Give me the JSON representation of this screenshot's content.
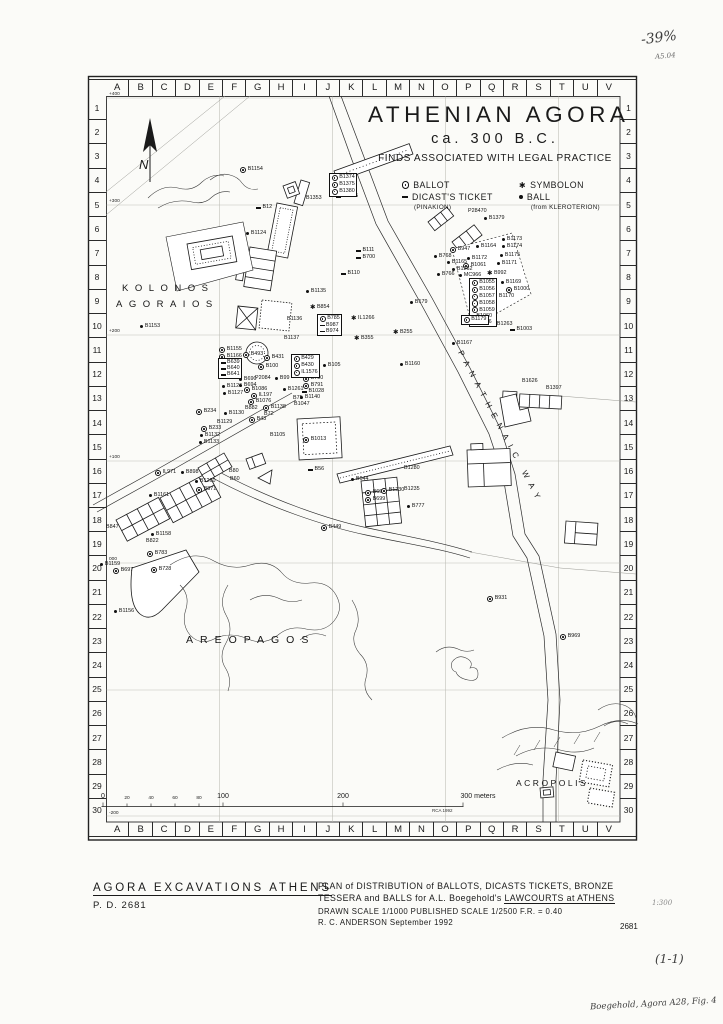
{
  "title": {
    "main": "ATHENIAN AGORA",
    "date": "ca. 300 B.C.",
    "subtitle": "FINDS ASSOCIATED WITH LEGAL PRACTICE"
  },
  "legend": {
    "columns": [
      [
        {
          "sym": "ballot",
          "label": "BALLOT"
        },
        {
          "sym": "ticket",
          "label": "DICAST'S TICKET",
          "sub": "(PINAKION)"
        }
      ],
      [
        {
          "sym": "symbolon",
          "label": "SYMBOLON"
        },
        {
          "sym": "ball",
          "label": "BALL",
          "sub": "(from KLEROTERION)"
        }
      ]
    ]
  },
  "compass": {
    "north": "N"
  },
  "grid": {
    "columns": [
      "A",
      "B",
      "C",
      "D",
      "E",
      "F",
      "G",
      "H",
      "I",
      "J",
      "K",
      "L",
      "M",
      "N",
      "O",
      "P",
      "Q",
      "R",
      "S",
      "T",
      "U",
      "V"
    ],
    "rows": [
      "1",
      "2",
      "3",
      "4",
      "5",
      "6",
      "7",
      "8",
      "9",
      "10",
      "11",
      "12",
      "13",
      "14",
      "15",
      "16",
      "17",
      "18",
      "19",
      "20",
      "21",
      "22",
      "23",
      "24",
      "25",
      "26",
      "27",
      "28",
      "29",
      "30"
    ],
    "elevations": [
      {
        "t": "+400",
        "y": 97
      },
      {
        "t": "+300",
        "y": 204
      },
      {
        "t": "+200",
        "y": 334
      },
      {
        "t": "+100",
        "y": 460
      },
      {
        "t": "000",
        "y": 562
      },
      {
        "t": "-200",
        "y": 816
      }
    ]
  },
  "region_labels": [
    {
      "text": "KOLONOS",
      "x": 122,
      "y": 283,
      "cls": "kolonos"
    },
    {
      "text": "AGORAIOS",
      "x": 116,
      "y": 299,
      "cls": "kolonos"
    },
    {
      "text": "AREOPAGOS",
      "x": 186,
      "y": 634,
      "cls": "areopagos"
    },
    {
      "text": "ACROPOLIS",
      "x": 516,
      "y": 778,
      "cls": "acropolis"
    },
    {
      "text": "PANATHENAIC WAY",
      "x": 464,
      "y": 349,
      "cls": "panathenaic"
    }
  ],
  "markers": [
    {
      "s": "ballot",
      "l": "B1154",
      "x": 240,
      "y": 170
    },
    {
      "s": "ticket",
      "l": "B1465",
      "x": 336,
      "y": 197
    },
    {
      "s": "none",
      "l": "B1353",
      "x": 306,
      "y": 199
    },
    {
      "s": "ticket",
      "l": "B12",
      "x": 256,
      "y": 208
    },
    {
      "s": "ball",
      "l": "B1124",
      "x": 246,
      "y": 234
    },
    {
      "s": "none",
      "l": "P28470",
      "x": 468,
      "y": 212
    },
    {
      "s": "ball",
      "l": "B1379",
      "x": 484,
      "y": 219
    },
    {
      "s": "ticket",
      "l": "B111",
      "x": 356,
      "y": 251
    },
    {
      "s": "ticket",
      "l": "B700",
      "x": 356,
      "y": 258
    },
    {
      "s": "ticket",
      "l": "B110",
      "x": 341,
      "y": 274
    },
    {
      "s": "ball",
      "l": "B1173",
      "x": 502,
      "y": 240
    },
    {
      "s": "ball",
      "l": "B1174",
      "x": 502,
      "y": 247
    },
    {
      "s": "ballot",
      "l": "B947",
      "x": 450,
      "y": 250
    },
    {
      "s": "ball",
      "l": "B1164",
      "x": 476,
      "y": 247
    },
    {
      "s": "ball",
      "l": "B768",
      "x": 434,
      "y": 257
    },
    {
      "s": "ball",
      "l": "B1165",
      "x": 447,
      "y": 263
    },
    {
      "s": "ball",
      "l": "B1172",
      "x": 467,
      "y": 259
    },
    {
      "s": "ballot",
      "l": "B1061",
      "x": 463,
      "y": 266
    },
    {
      "s": "ball",
      "l": "B1175",
      "x": 500,
      "y": 256
    },
    {
      "s": "ball",
      "l": "B1171",
      "x": 497,
      "y": 264
    },
    {
      "s": "ball",
      "l": "B1262",
      "x": 452,
      "y": 270
    },
    {
      "s": "ball",
      "l": "B766",
      "x": 437,
      "y": 275
    },
    {
      "s": "ball",
      "l": "MC966",
      "x": 459,
      "y": 276
    },
    {
      "s": "symbolon",
      "l": "B992",
      "x": 487,
      "y": 274
    },
    {
      "s": "ball",
      "l": "B1169",
      "x": 501,
      "y": 283
    },
    {
      "s": "ballot",
      "l": "B1000",
      "x": 506,
      "y": 290
    },
    {
      "s": "ball",
      "l": "B1170",
      "x": 494,
      "y": 297
    },
    {
      "s": "ball",
      "l": "B1263",
      "x": 492,
      "y": 325
    },
    {
      "s": "ticket",
      "l": "B1003",
      "x": 510,
      "y": 330
    },
    {
      "s": "ball",
      "l": "B179",
      "x": 410,
      "y": 303
    },
    {
      "s": "ball",
      "l": "B1167",
      "x": 452,
      "y": 344
    },
    {
      "s": "ball",
      "l": "B1160",
      "x": 400,
      "y": 365
    },
    {
      "s": "none",
      "l": "B1626",
      "x": 522,
      "y": 382
    },
    {
      "s": "none",
      "l": "B1397",
      "x": 546,
      "y": 389
    },
    {
      "s": "ball",
      "l": "B1135",
      "x": 306,
      "y": 292
    },
    {
      "s": "symbolon",
      "l": "B854",
      "x": 310,
      "y": 308
    },
    {
      "s": "none",
      "l": "B1136",
      "x": 287,
      "y": 320
    },
    {
      "s": "symbolon",
      "l": "IL1266",
      "x": 351,
      "y": 319
    },
    {
      "s": "symbolon",
      "l": "B355",
      "x": 354,
      "y": 339
    },
    {
      "s": "symbolon",
      "l": "B255",
      "x": 393,
      "y": 333
    },
    {
      "s": "none",
      "l": "B1137",
      "x": 284,
      "y": 339
    },
    {
      "s": "ball",
      "l": "B1153",
      "x": 140,
      "y": 327
    },
    {
      "s": "ballot",
      "l": "B1155",
      "x": 219,
      "y": 350
    },
    {
      "s": "ballot",
      "l": "B1166",
      "x": 219,
      "y": 357
    },
    {
      "s": "ball",
      "l": "B1126",
      "x": 222,
      "y": 387
    },
    {
      "s": "ball",
      "l": "B1127",
      "x": 223,
      "y": 394
    },
    {
      "s": "ballot",
      "l": "B234",
      "x": 196,
      "y": 412
    },
    {
      "s": "ball",
      "l": "B1130",
      "x": 224,
      "y": 414
    },
    {
      "s": "none",
      "l": "B1129",
      "x": 217,
      "y": 423
    },
    {
      "s": "ballot",
      "l": "B233",
      "x": 201,
      "y": 429
    },
    {
      "s": "ball",
      "l": "B1132",
      "x": 200,
      "y": 436
    },
    {
      "s": "ball",
      "l": "B1133",
      "x": 199,
      "y": 443
    },
    {
      "s": "ballot",
      "l": "B493",
      "x": 243,
      "y": 355
    },
    {
      "s": "ballot",
      "l": "B431",
      "x": 264,
      "y": 358
    },
    {
      "s": "ballot",
      "l": "B100",
      "x": 258,
      "y": 367
    },
    {
      "s": "ball",
      "l": "B105",
      "x": 323,
      "y": 366
    },
    {
      "s": "ballot",
      "l": "B790",
      "x": 303,
      "y": 379
    },
    {
      "s": "ballot",
      "l": "B791",
      "x": 303,
      "y": 386
    },
    {
      "s": "ticket",
      "l": "B1028",
      "x": 302,
      "y": 392
    },
    {
      "s": "ball",
      "l": "B1140",
      "x": 300,
      "y": 398
    },
    {
      "s": "ball",
      "l": "B690",
      "x": 239,
      "y": 380
    },
    {
      "s": "ball",
      "l": "B694",
      "x": 239,
      "y": 386
    },
    {
      "s": "none",
      "l": "P2084",
      "x": 255,
      "y": 379
    },
    {
      "s": "ball",
      "l": "B99",
      "x": 275,
      "y": 379
    },
    {
      "s": "ballot",
      "l": "B1086",
      "x": 244,
      "y": 390
    },
    {
      "s": "ballot",
      "l": "IL197",
      "x": 251,
      "y": 396
    },
    {
      "s": "ballot",
      "l": "B1076",
      "x": 248,
      "y": 402
    },
    {
      "s": "ball",
      "l": "B1261",
      "x": 283,
      "y": 390
    },
    {
      "s": "none",
      "l": "B75",
      "x": 293,
      "y": 399
    },
    {
      "s": "none",
      "l": "B1047",
      "x": 294,
      "y": 405
    },
    {
      "s": "ballot",
      "l": "B1138",
      "x": 263,
      "y": 408
    },
    {
      "s": "none",
      "l": "B72",
      "x": 264,
      "y": 415
    },
    {
      "s": "none",
      "l": "B882",
      "x": 245,
      "y": 409
    },
    {
      "s": "ballot",
      "l": "B43",
      "x": 249,
      "y": 420
    },
    {
      "s": "none",
      "l": "B1105",
      "x": 270,
      "y": 436
    },
    {
      "s": "ballot",
      "l": "B1013",
      "x": 303,
      "y": 440
    },
    {
      "s": "ticket",
      "l": "B56",
      "x": 308,
      "y": 470
    },
    {
      "s": "none",
      "l": "B80",
      "x": 229,
      "y": 472
    },
    {
      "s": "none",
      "l": "B60",
      "x": 230,
      "y": 480
    },
    {
      "s": "ballot",
      "l": "IL971",
      "x": 155,
      "y": 473
    },
    {
      "s": "ball",
      "l": "B898",
      "x": 181,
      "y": 473
    },
    {
      "s": "ball",
      "l": "B1260",
      "x": 195,
      "y": 482
    },
    {
      "s": "ballot",
      "l": "B871",
      "x": 196,
      "y": 490
    },
    {
      "s": "ball",
      "l": "B1161",
      "x": 149,
      "y": 496
    },
    {
      "s": "none",
      "l": "B847",
      "x": 106,
      "y": 528
    },
    {
      "s": "ball",
      "l": "B1158",
      "x": 151,
      "y": 535
    },
    {
      "s": "none",
      "l": "B822",
      "x": 146,
      "y": 542
    },
    {
      "s": "ballot",
      "l": "B783",
      "x": 147,
      "y": 554
    },
    {
      "s": "ball",
      "l": "B1159",
      "x": 100,
      "y": 565
    },
    {
      "s": "ballot",
      "l": "B697",
      "x": 113,
      "y": 571
    },
    {
      "s": "ballot",
      "l": "B728",
      "x": 151,
      "y": 570
    },
    {
      "s": "ball",
      "l": "B1156",
      "x": 114,
      "y": 612
    },
    {
      "s": "ballot",
      "l": "B449",
      "x": 321,
      "y": 528
    },
    {
      "s": "none",
      "l": "B1280",
      "x": 404,
      "y": 469
    },
    {
      "s": "ball",
      "l": "B644",
      "x": 351,
      "y": 480
    },
    {
      "s": "ballot",
      "l": "B698",
      "x": 365,
      "y": 493
    },
    {
      "s": "ballot",
      "l": "B699",
      "x": 365,
      "y": 500
    },
    {
      "s": "ballot",
      "l": "B1230",
      "x": 381,
      "y": 491
    },
    {
      "s": "none",
      "l": "B1235",
      "x": 404,
      "y": 490
    },
    {
      "s": "ball",
      "l": "B777",
      "x": 407,
      "y": 507
    },
    {
      "s": "ballot",
      "l": "B931",
      "x": 487,
      "y": 599
    },
    {
      "s": "ballot",
      "l": "B969",
      "x": 560,
      "y": 637
    }
  ],
  "marker_boxes": [
    {
      "x": 329,
      "y": 175,
      "items": [
        {
          "s": "ballot",
          "l": "B1374"
        },
        {
          "s": "ballot",
          "l": "B1375"
        },
        {
          "s": "ballot",
          "l": "B1380"
        }
      ]
    },
    {
      "x": 317,
      "y": 316,
      "items": [
        {
          "s": "ballot",
          "l": "B785"
        },
        {
          "s": "ticket",
          "l": "B987"
        },
        {
          "s": "ticket",
          "l": "B974"
        }
      ]
    },
    {
      "x": 291,
      "y": 356,
      "items": [
        {
          "s": "ballot",
          "l": "B429"
        },
        {
          "s": "ballot",
          "l": "B430"
        },
        {
          "s": "ballot",
          "l": "IL1576"
        }
      ]
    },
    {
      "x": 469,
      "y": 280,
      "items": [
        {
          "s": "ballot",
          "l": "B1055"
        },
        {
          "s": "ballot",
          "l": "B1056"
        },
        {
          "s": "ballot",
          "l": "B1057"
        },
        {
          "s": "ballot",
          "l": "B1058"
        },
        {
          "s": "ballot",
          "l": "B1059"
        },
        {
          "s": "ball",
          "l": "B1060"
        },
        {
          "s": "ball",
          "l": "B1176"
        }
      ]
    },
    {
      "x": 218,
      "y": 360,
      "items": [
        {
          "s": "ticket",
          "l": "B639"
        },
        {
          "s": "ticket",
          "l": "B640"
        },
        {
          "s": "ticket",
          "l": "B641"
        }
      ]
    },
    {
      "x": 461,
      "y": 317,
      "items": [
        {
          "s": "ballot",
          "l": "B1179"
        }
      ]
    }
  ],
  "scale_bar": {
    "labels": [
      {
        "t": "0",
        "x": 103,
        "s": "b"
      },
      {
        "t": "20",
        "x": 127,
        "s": "s"
      },
      {
        "t": "40",
        "x": 151,
        "s": "s"
      },
      {
        "t": "60",
        "x": 175,
        "s": "s"
      },
      {
        "t": "80",
        "x": 199,
        "s": "s"
      },
      {
        "t": "100",
        "x": 223,
        "s": "b"
      },
      {
        "t": "200",
        "x": 343,
        "s": "b"
      },
      {
        "t": "300 meters",
        "x": 478,
        "s": "b"
      }
    ],
    "credit": "RCA 1992"
  },
  "caption": {
    "heading": "AGORA EXCAVATIONS ATHENS",
    "pd": "P. D. 2681",
    "line1": "PLAN of DISTRIBUTION of BALLOTS, DICASTS TICKETS, BRONZE",
    "line2_pre": "TESSERA and BALLS for A.L. Boegehold's ",
    "line2_underline": "LAWCOURTS at ATHENS",
    "line3": "DRAWN SCALE 1/1000    PUBLISHED SCALE 1/2500    F.R. = 0.40",
    "line4": "R. C. ANDERSON    September 1992",
    "number": "2681"
  },
  "annotations": {
    "percent": "-39%",
    "code": "A5.04",
    "ratio": "1:300",
    "series": "(1-1)",
    "citation": "Boegehold, Agora A28, Fig. 4"
  }
}
